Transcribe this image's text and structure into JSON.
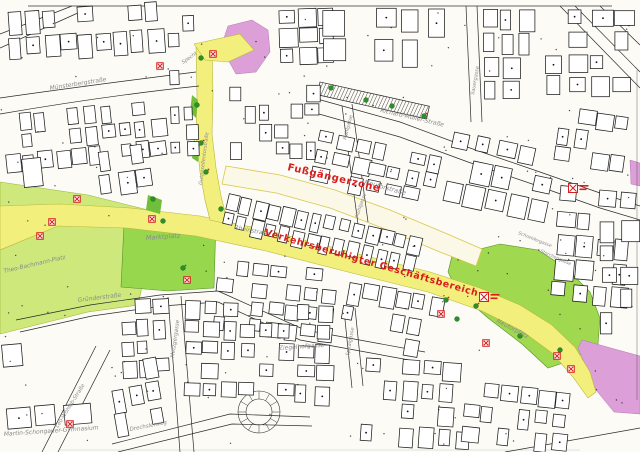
{
  "map": {
    "colors": {
      "street_yellow": "#f2ef7d",
      "pedestrian_cream": "#fcf8e8",
      "square_green": "#9ad44e",
      "plaza_light_green": "#cfe87c",
      "special_pink": "#dc9fd8",
      "sign_red": "#d81e1e",
      "label_gray": "#8a8a8a",
      "line_black": "#1c1c1c"
    },
    "zone_labels": [
      {
        "text": "Fußgängerzone",
        "x": 287,
        "y": 170,
        "rotate": 13,
        "size": 10
      },
      {
        "text": "Verkehrsberuhigter Geschäftsbereich",
        "x": 264,
        "y": 235,
        "rotate": 16,
        "size": 9.5
      }
    ],
    "street_labels": [
      {
        "text": "Münsterbergstraße",
        "x": 50,
        "y": 90,
        "rotate": -9,
        "size": 6
      },
      {
        "text": "Specht",
        "x": 183,
        "y": 64,
        "rotate": -35,
        "size": 5
      },
      {
        "text": "Gutgesellentorstraße",
        "x": 202,
        "y": 185,
        "rotate": -83,
        "size": 5
      },
      {
        "text": "Richard-Müller-Straße",
        "x": 380,
        "y": 112,
        "rotate": 13,
        "size": 6
      },
      {
        "text": "Sauergasse",
        "x": 474,
        "y": 95,
        "rotate": -80,
        "size": 5
      },
      {
        "text": "Neutorstraße",
        "x": 364,
        "y": 184,
        "rotate": 15,
        "size": 6.5
      },
      {
        "text": "Mühlgasse",
        "x": 346,
        "y": 140,
        "rotate": -75,
        "size": 4.8
      },
      {
        "text": "Mühlgasse",
        "x": 358,
        "y": 218,
        "rotate": -72,
        "size": 4.8
      },
      {
        "text": "Rheinstraße",
        "x": 234,
        "y": 229,
        "rotate": 11,
        "size": 6
      },
      {
        "text": "Marktplatz",
        "x": 146,
        "y": 240,
        "rotate": -4,
        "size": 6.5
      },
      {
        "text": "Theo-Bachmann-Platz",
        "x": 4,
        "y": 273,
        "rotate": -13,
        "size": 5.8
      },
      {
        "text": "Gründerstraße",
        "x": 78,
        "y": 302,
        "rotate": -7,
        "size": 6
      },
      {
        "text": "Metzgergasse",
        "x": 174,
        "y": 358,
        "rotate": -82,
        "size": 5.5
      },
      {
        "text": "Ziegelhofgasse",
        "x": 279,
        "y": 350,
        "rotate": -4,
        "size": 6
      },
      {
        "text": "Spitalgasse",
        "x": 349,
        "y": 356,
        "rotate": -80,
        "size": 5
      },
      {
        "text": "Leo-Wohleb-Straße",
        "x": 58,
        "y": 428,
        "rotate": -58,
        "size": 5.3
      },
      {
        "text": "Martin-Schongauer-Gymnasium",
        "x": 4,
        "y": 436,
        "rotate": -4,
        "size": 6
      },
      {
        "text": "Drechslerweg",
        "x": 130,
        "y": 431,
        "rotate": -11,
        "size": 5.5
      },
      {
        "text": "Neutorplatz",
        "x": 496,
        "y": 322,
        "rotate": 28,
        "size": 6
      },
      {
        "text": "Schneidergasse",
        "x": 518,
        "y": 234,
        "rotate": 22,
        "size": 4.5
      },
      {
        "text": "Storchengasse",
        "x": 540,
        "y": 252,
        "rotate": 24,
        "size": 4.5
      }
    ],
    "signs": [
      {
        "x": 160,
        "y": 66,
        "note": false
      },
      {
        "x": 213,
        "y": 54,
        "note": false
      },
      {
        "x": 77,
        "y": 199,
        "note": false
      },
      {
        "x": 52,
        "y": 222,
        "note": false
      },
      {
        "x": 40,
        "y": 236,
        "note": false
      },
      {
        "x": 152,
        "y": 219,
        "note": false
      },
      {
        "x": 187,
        "y": 280,
        "note": false
      },
      {
        "x": 573,
        "y": 188,
        "note": true
      },
      {
        "x": 484,
        "y": 297,
        "note": true
      },
      {
        "x": 441,
        "y": 314,
        "note": false
      },
      {
        "x": 486,
        "y": 343,
        "note": false
      },
      {
        "x": 557,
        "y": 356,
        "note": false
      },
      {
        "x": 571,
        "y": 369,
        "note": false
      },
      {
        "x": 70,
        "y": 424,
        "note": false
      }
    ],
    "tree_markers": [
      {
        "x": 153,
        "y": 199
      },
      {
        "x": 163,
        "y": 221
      },
      {
        "x": 197,
        "y": 105
      },
      {
        "x": 201,
        "y": 143
      },
      {
        "x": 206,
        "y": 172
      },
      {
        "x": 221,
        "y": 209
      },
      {
        "x": 201,
        "y": 58
      },
      {
        "x": 446,
        "y": 300
      },
      {
        "x": 457,
        "y": 319
      },
      {
        "x": 476,
        "y": 306
      },
      {
        "x": 520,
        "y": 336
      },
      {
        "x": 560,
        "y": 350
      },
      {
        "x": 183,
        "y": 268
      },
      {
        "x": 331,
        "y": 88
      },
      {
        "x": 366,
        "y": 100
      },
      {
        "x": 392,
        "y": 106
      },
      {
        "x": 424,
        "y": 116
      }
    ]
  }
}
